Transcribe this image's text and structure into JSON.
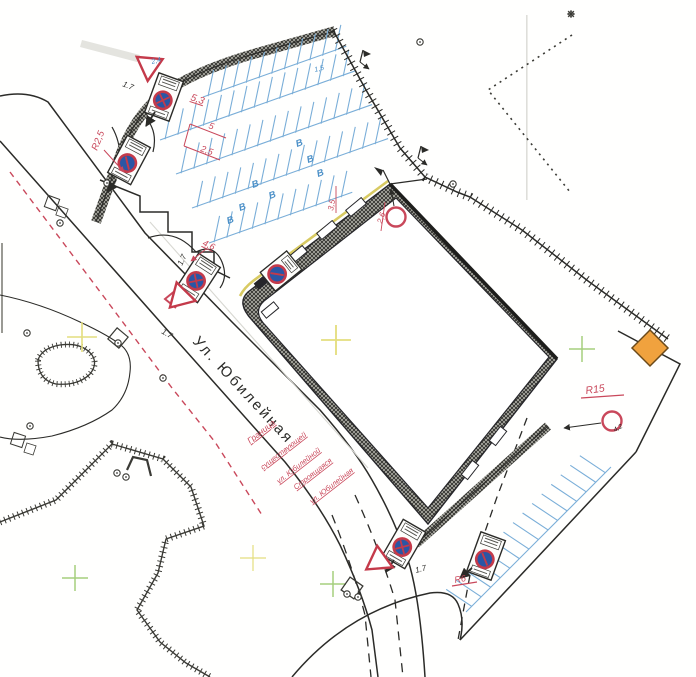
{
  "street": {
    "name": "Ул. Юбилейная"
  },
  "boundary_labels": {
    "existing": {
      "l1": "Граница",
      "l2": "существующей",
      "l3": "ул. Юбилейной"
    },
    "construction": {
      "l1": "Строящаяся",
      "l2": "ул. Юбилейная"
    }
  },
  "annotations": {
    "r2_5": "R2,5",
    "d5_3": "5,3",
    "d5": "5",
    "d2_5": "2,5",
    "d4_6": "4,6",
    "d2_6": "2,6",
    "d3_5": "3,5",
    "r15": "R15",
    "r6": "R6",
    "d4_2": "4,2",
    "d2_4": "2,4",
    "d1_5": "1,5",
    "d1_7": "1.7",
    "accessible_label": "В"
  },
  "colors": {
    "annotation_red": "#c9485b",
    "sign_ring_red": "#c43a4a",
    "sign_blue": "#2a56a5",
    "parking_blue": "#7aaed8",
    "marker_orange": "#f0a23e",
    "survey_green": "#a5cf7d",
    "survey_yellow": "#e4de7e",
    "building_axis_khaki": "#d6c75a"
  }
}
